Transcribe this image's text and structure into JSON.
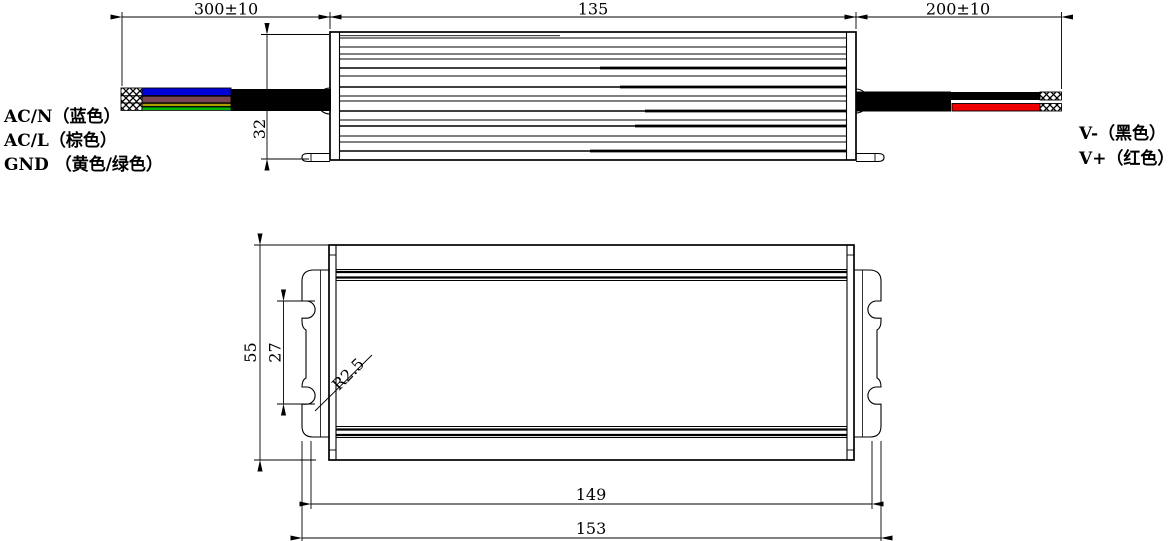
{
  "drawing": {
    "dim_input_cable": "300±10",
    "dim_body_length": "135",
    "dim_output_cable": "200±10",
    "dim_body_height": "32",
    "dim_body_width": "55",
    "dim_slot_spacing": "27",
    "dim_slot_radius": "R2.5",
    "dim_mount_length": "149",
    "dim_overall_length": "153",
    "label_acn": "AC/N（蓝色）",
    "label_acl": "AC/L（棕色）",
    "label_gnd": "GND （黄色/绿色）",
    "label_vminus": "V-（黑色）",
    "label_vplus": "V+（红色）",
    "colors": {
      "wire_blue": "#0000d9",
      "wire_brown": "#7a4450",
      "wire_yellow": "#a8a000",
      "wire_green": "#00b400",
      "wire_red": "#ee0000",
      "cable_black": "#000000"
    }
  }
}
